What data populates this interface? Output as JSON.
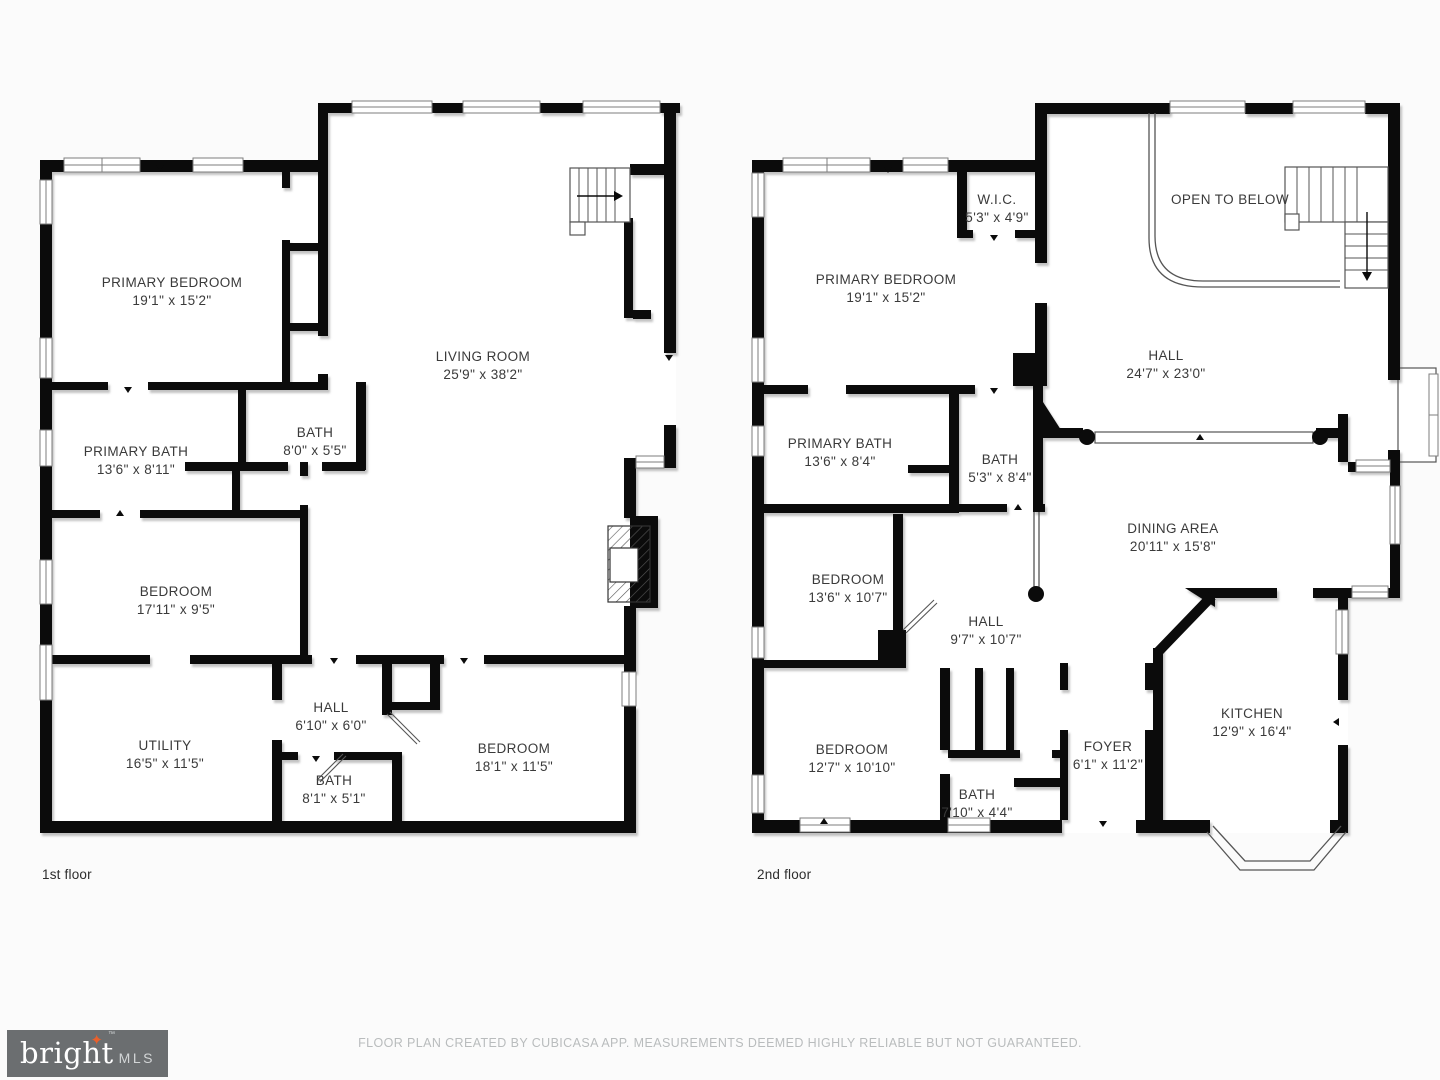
{
  "floor1": {
    "label": "1st floor",
    "rooms": {
      "primary_bedroom": {
        "name": "PRIMARY BEDROOM",
        "dims": "19'1\" x 15'2\""
      },
      "living_room": {
        "name": "LIVING ROOM",
        "dims": "25'9\" x 38'2\""
      },
      "primary_bath": {
        "name": "PRIMARY BATH",
        "dims": "13'6\" x 8'11\""
      },
      "bath": {
        "name": "BATH",
        "dims": "8'0\" x 5'5\""
      },
      "bedroom_mid": {
        "name": "BEDROOM",
        "dims": "17'11\" x 9'5\""
      },
      "utility": {
        "name": "UTILITY",
        "dims": "16'5\" x 11'5\""
      },
      "hall": {
        "name": "HALL",
        "dims": "6'10\" x 6'0\""
      },
      "bath_small": {
        "name": "BATH",
        "dims": "8'1\" x 5'1\""
      },
      "bedroom_br": {
        "name": "BEDROOM",
        "dims": "18'1\" x 11'5\""
      }
    }
  },
  "floor2": {
    "label": "2nd floor",
    "rooms": {
      "wic": {
        "name": "W.I.C.",
        "dims": "5'3\" x 4'9\""
      },
      "open_below": {
        "name": "OPEN TO BELOW"
      },
      "primary_bedroom": {
        "name": "PRIMARY BEDROOM",
        "dims": "19'1\" x 15'2\""
      },
      "hall_upper": {
        "name": "HALL",
        "dims": "24'7\" x 23'0\""
      },
      "primary_bath": {
        "name": "PRIMARY BATH",
        "dims": "13'6\" x 8'4\""
      },
      "bath_upper": {
        "name": "BATH",
        "dims": "5'3\" x 8'4\""
      },
      "dining": {
        "name": "DINING AREA",
        "dims": "20'11\" x 15'8\""
      },
      "bedroom_mid": {
        "name": "BEDROOM",
        "dims": "13'6\" x 10'7\""
      },
      "hall_lower": {
        "name": "HALL",
        "dims": "9'7\" x 10'7\""
      },
      "bedroom_lower": {
        "name": "BEDROOM",
        "dims": "12'7\" x 10'10\""
      },
      "bath_lower": {
        "name": "BATH",
        "dims": "7'10\" x 4'4\""
      },
      "foyer": {
        "name": "FOYER",
        "dims": "6'1\" x 11'2\""
      },
      "kitchen": {
        "name": "KITCHEN",
        "dims": "12'9\" x 16'4\""
      }
    }
  },
  "footer": {
    "logo": {
      "brand": "bright",
      "suffix": "MLS",
      "tm": "™",
      "star": "✦"
    },
    "disclaimer": "FLOOR PLAN CREATED BY CUBICASA APP. MEASUREMENTS DEEMED HIGHLY RELIABLE BUT NOT GUARANTEED."
  }
}
